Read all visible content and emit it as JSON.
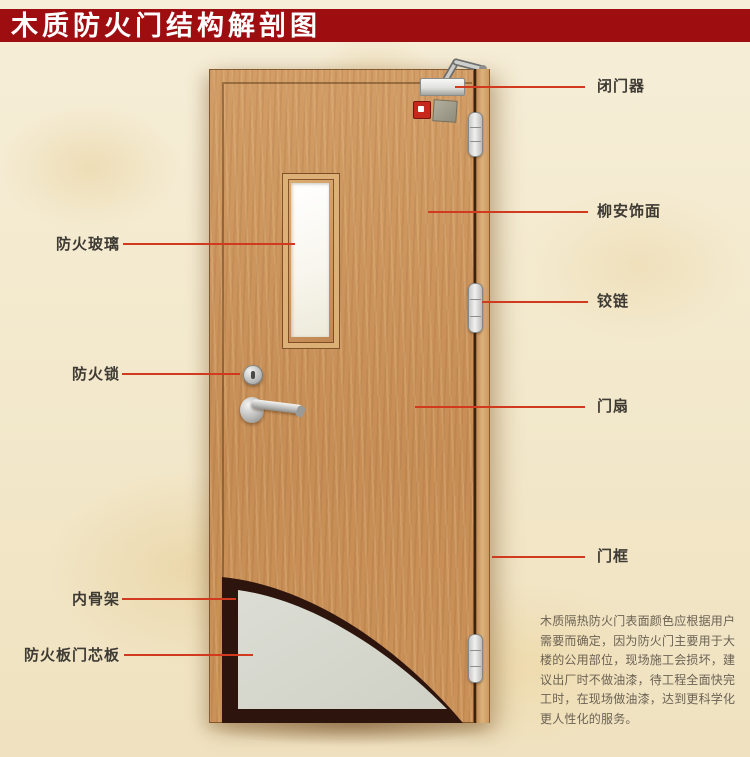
{
  "title": "木质防火门结构解剖图",
  "labels_left": [
    {
      "id": "fire-glass",
      "text": "防火玻璃"
    },
    {
      "id": "fire-lock",
      "text": "防火锁"
    },
    {
      "id": "inner-skeleton",
      "text": "内骨架"
    },
    {
      "id": "fire-board-core",
      "text": "防火板门芯板"
    }
  ],
  "labels_right": [
    {
      "id": "door-closer",
      "text": "闭门器"
    },
    {
      "id": "lauan-veneer",
      "text": "柳安饰面"
    },
    {
      "id": "hinge",
      "text": "铰链"
    },
    {
      "id": "door-leaf",
      "text": "门扇"
    },
    {
      "id": "door-frame",
      "text": "门框"
    }
  ],
  "description": {
    "text": "木质隔热防火门表面颜色应根据用户\n需要而确定，因为防火门主要用于大\n楼的公用部位，现场施工会损坏，建\n议出厂时不做油漆，待工程全面快完\n工时，在现场做油漆，达到更科学化\n更人性化的服务。"
  },
  "colors": {
    "banner": "#9e0d10",
    "leader": "#d13a1e",
    "wood": "#c98f57",
    "frame-wood": "#dcb27c",
    "core-grey": "#d6d7ce",
    "skeleton-dark": "#2d140c"
  }
}
